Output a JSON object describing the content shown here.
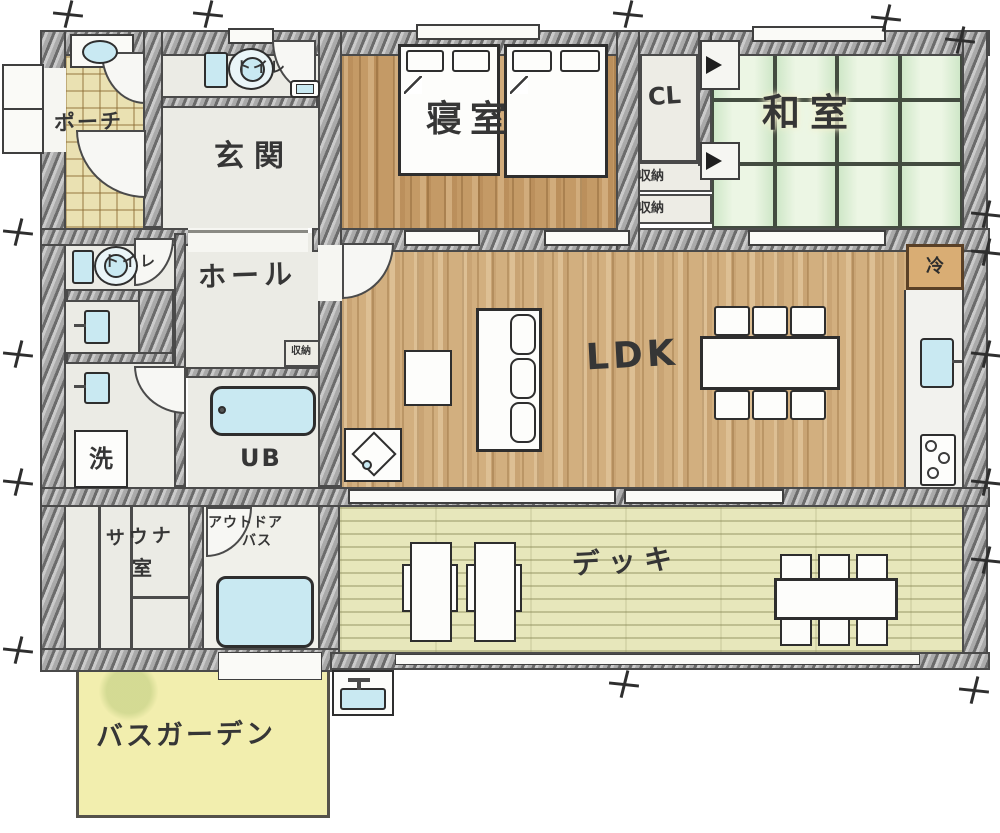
{
  "labels": {
    "porch": "ポーチ",
    "genkan": "玄関",
    "toilet_upper": "トイレ",
    "toilet_lower": "トイレ",
    "bedroom": "寝室",
    "cl": "CL",
    "washitsu": "和室",
    "storage_a": "収納",
    "storage_b": "収納",
    "hall": "ホール",
    "hall_storage": "収納",
    "laundry": "洗",
    "unit_bath": "UB",
    "ldk": "LDK",
    "fridge": "冷",
    "sauna_line1": "サウナ",
    "sauna_line2": "室",
    "outdoor_bath_line1": "アウトドア",
    "outdoor_bath_line2": "バス",
    "deck": "デッキ",
    "bath_garden": "バスガーデン"
  },
  "colors": {
    "wall_gray": "#aaaaaa",
    "ink": "#363636",
    "wood_bedroom": "#c49a66",
    "wood_ldk": "#d2af7f",
    "tatami_green": "#dcedd5",
    "deck_yellow": "#e7e7bb",
    "porch_tile": "#eae1b2",
    "bath_garden_yellow": "#f2eeae",
    "water_blue": "#c9e9f2",
    "room_gray": "#ebebe5",
    "fridge_wood": "#d9ad74"
  }
}
